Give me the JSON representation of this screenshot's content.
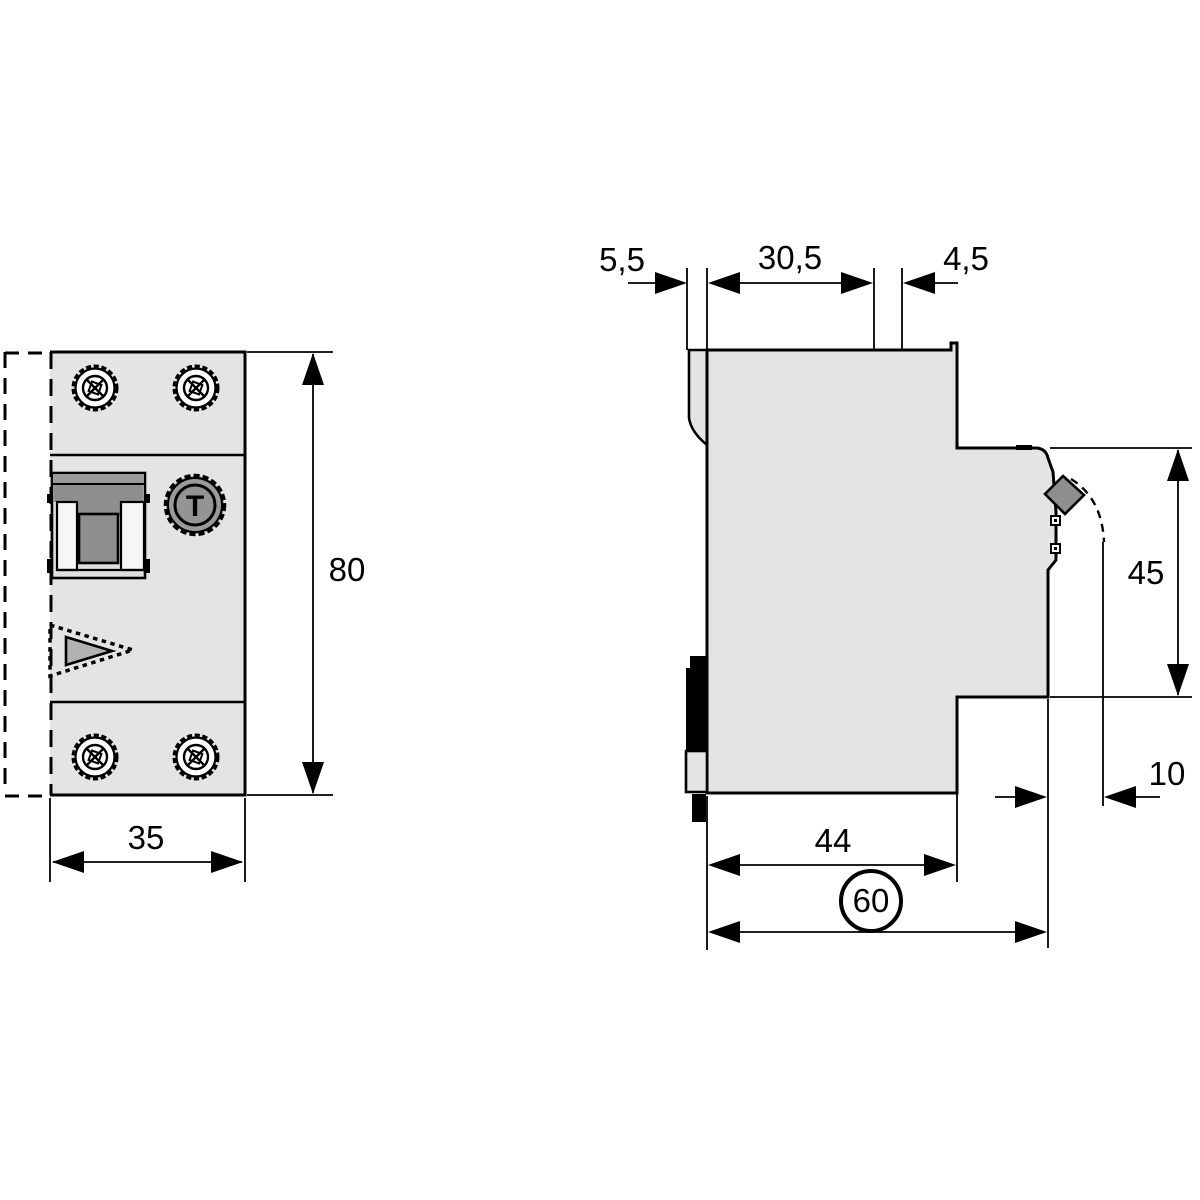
{
  "colors": {
    "line": "#000000",
    "body_fill": "#e4e4e4",
    "detail_gray": "#8e8e8e",
    "strip_gray": "#9a9a9a",
    "inner_triangle_gray": "#b2b2b2",
    "white": "#ffffff"
  },
  "front_view": {
    "width_label": "35",
    "height_label": "80",
    "test_button_label": "T"
  },
  "side_view": {
    "din_claw_label": "5,5",
    "top_width_label": "30,5",
    "top_step_label": "4,5",
    "front_height_label": "45",
    "handle_clearance_label": "10",
    "depth_label": "44",
    "total_depth_label": "60"
  }
}
